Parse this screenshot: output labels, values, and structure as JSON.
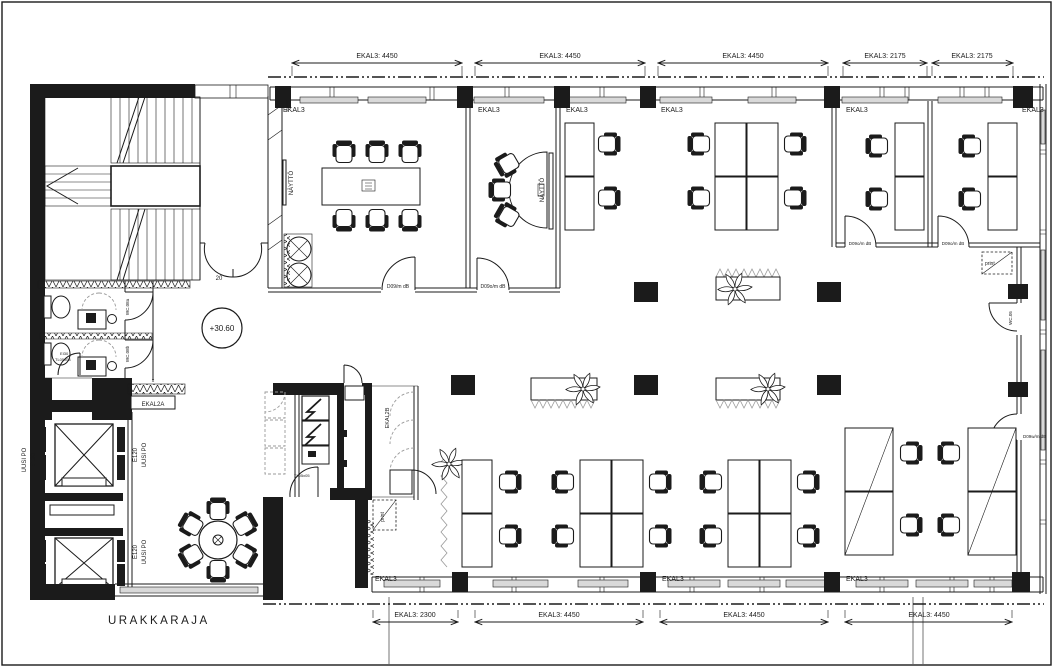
{
  "colors": {
    "line": "#1b1b1b",
    "glass": "#d9d9d9",
    "dashed_grey": "#9a9a9a",
    "background": "#ffffff"
  },
  "dim_top": [
    "EKAL3: 4450",
    "EKAL3: 4450",
    "EKAL3: 4450",
    "EKAL3: 2175",
    "EKAL3: 2175"
  ],
  "dim_bottom": [
    "EKAL3: 2300",
    "EKAL3: 4450",
    "EKAL3: 4450",
    "EKAL3: 4450"
  ],
  "wall_labels_top": [
    "EKAL3",
    "EKAL3",
    "EKAL3",
    "EKAL3",
    "EKAL3",
    "EKAL3"
  ],
  "wall_labels_bottom": [
    "EKAL3",
    "EKAL3",
    "EKAL3"
  ],
  "labels": {
    "level_marker": "+30.60",
    "contract_boundary": "URAKKARAJA",
    "display_conference": "NÄYTTÖ",
    "display_meeting": "NÄYTTÖ",
    "door_conference": "D09/m dB",
    "door_meeting": "D09o/m dB",
    "door_office_1": "D09o/m dB",
    "door_office_2": "D09o/m dB",
    "door_right_wall": "D09w/m dB",
    "wc_top": "WC.08a",
    "wc_bottom": "WC.08b",
    "wc_right": "WC.05",
    "fire_door_class": "EI30",
    "fire_door_type": "TL05x08",
    "core_door_type": "TL05x05",
    "shaft_label_a": "EKAL2A",
    "shaft_label_b": "EKAL2B",
    "print_station_1": "print",
    "print_station_2": "print",
    "stair_door_width": "20",
    "duct_boxing": "kotelo",
    "demolition_mark": "x"
  }
}
